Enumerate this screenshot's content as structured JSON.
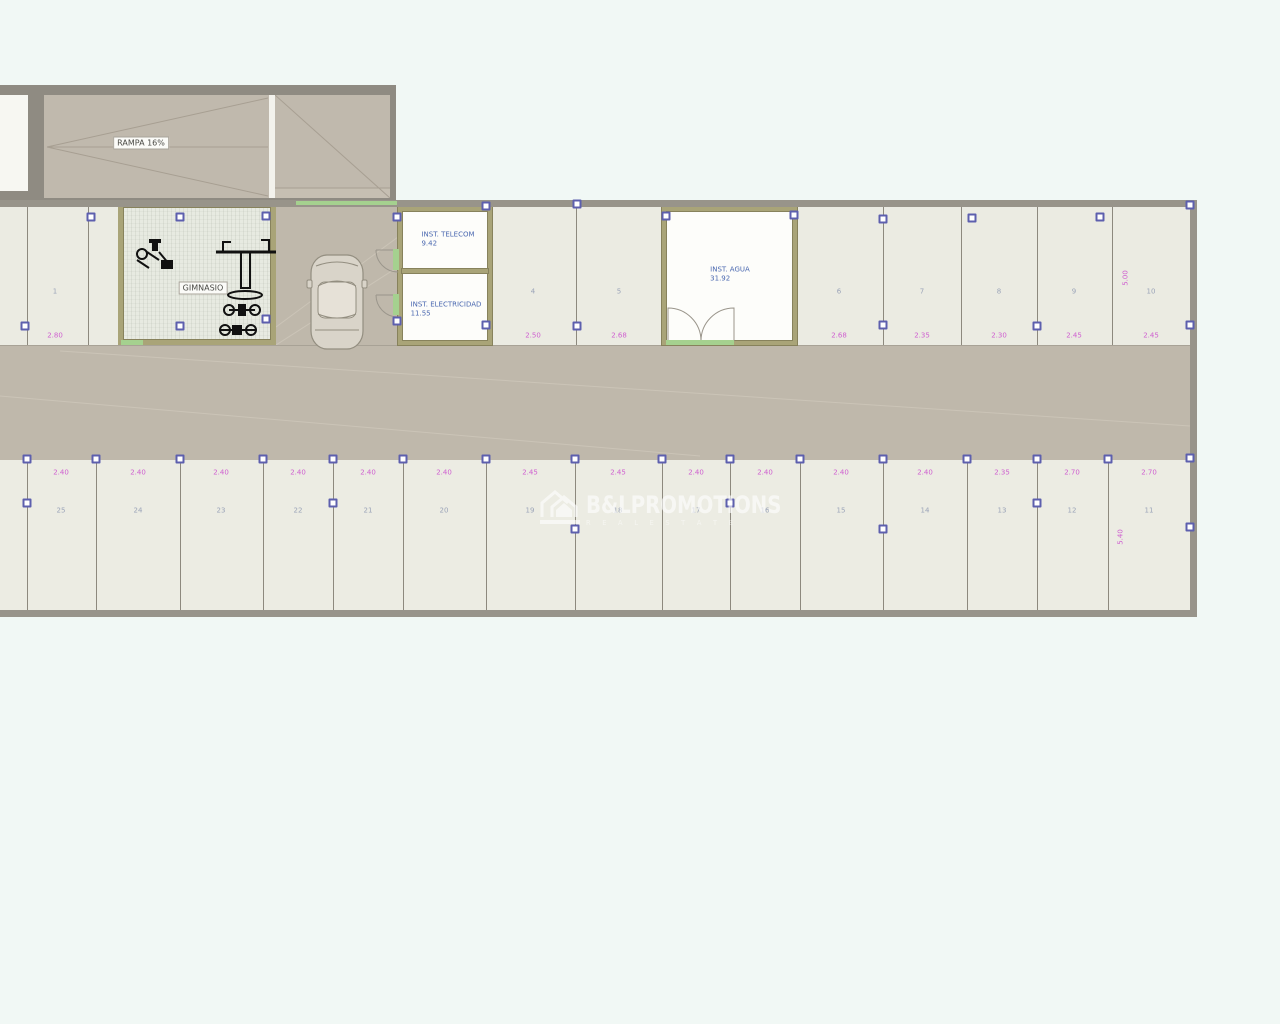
{
  "ramp": {
    "label": "RAMPA 16%"
  },
  "gym": {
    "label": "GIMNASIO"
  },
  "rooms": {
    "telecom": {
      "name": "INST. TELECOM",
      "area": "9.42"
    },
    "electricidad": {
      "name": "INST. ELECTRICIDAD",
      "area": "11.55"
    },
    "agua": {
      "name": "INST. AGUA",
      "area": "31.92"
    }
  },
  "watermark": {
    "brand": "B&LPROMOTIONS",
    "subtitle": "R E A L   E S T A T E",
    "icon": "house-icon"
  },
  "parking": {
    "top_row": {
      "zone": {
        "top": 207,
        "bottom": 345,
        "number_y": 292,
        "dim_y": 336
      },
      "dividers": [
        27,
        88,
        576,
        883,
        961,
        1037,
        1112
      ],
      "stalls": [
        {
          "cx": 55,
          "number": "1",
          "dim": "2.80"
        },
        {
          "cx": 533,
          "number": "4",
          "dim": "2.50"
        },
        {
          "cx": 619,
          "number": "5",
          "dim": "2.68"
        },
        {
          "cx": 839,
          "number": "6",
          "dim": "2.68"
        },
        {
          "cx": 922,
          "number": "7",
          "dim": "2.35"
        },
        {
          "cx": 999,
          "number": "8",
          "dim": "2.30"
        },
        {
          "cx": 1074,
          "number": "9",
          "dim": "2.45"
        },
        {
          "cx": 1151,
          "number": "10",
          "dim": "2.45"
        }
      ]
    },
    "bottom_row": {
      "zone": {
        "top": 460,
        "bottom": 610,
        "number_y": 511,
        "dim_y": 473
      },
      "dividers": [
        27,
        96,
        180,
        263,
        333,
        403,
        486,
        575,
        662,
        730,
        800,
        883,
        967,
        1037,
        1108
      ],
      "stalls": [
        {
          "cx": 61,
          "number": "25",
          "dim": "2.40"
        },
        {
          "cx": 138,
          "number": "24",
          "dim": "2.40"
        },
        {
          "cx": 221,
          "number": "23",
          "dim": "2.40"
        },
        {
          "cx": 298,
          "number": "22",
          "dim": "2.40"
        },
        {
          "cx": 368,
          "number": "21",
          "dim": "2.40"
        },
        {
          "cx": 444,
          "number": "20",
          "dim": "2.40"
        },
        {
          "cx": 530,
          "number": "19",
          "dim": "2.45"
        },
        {
          "cx": 618,
          "number": "18",
          "dim": "2.45"
        },
        {
          "cx": 696,
          "number": "17",
          "dim": "2.40"
        },
        {
          "cx": 765,
          "number": "16",
          "dim": "2.40"
        },
        {
          "cx": 841,
          "number": "15",
          "dim": "2.40"
        },
        {
          "cx": 925,
          "number": "14",
          "dim": "2.40"
        },
        {
          "cx": 1002,
          "number": "13",
          "dim": "2.35"
        },
        {
          "cx": 1072,
          "number": "12",
          "dim": "2.70"
        },
        {
          "cx": 1149,
          "number": "11",
          "dim": "2.70"
        }
      ]
    },
    "vertical_dims": [
      {
        "x": 1126,
        "y": 278,
        "text": "5.00"
      },
      {
        "x": 1121,
        "y": 537,
        "text": "5.40"
      }
    ]
  },
  "grips": [
    [
      91,
      217
    ],
    [
      180,
      217
    ],
    [
      266,
      216
    ],
    [
      25,
      326
    ],
    [
      180,
      326
    ],
    [
      266,
      319
    ],
    [
      397,
      217
    ],
    [
      397,
      321
    ],
    [
      486,
      206
    ],
    [
      577,
      204
    ],
    [
      577,
      326
    ],
    [
      486,
      325
    ],
    [
      666,
      216
    ],
    [
      794,
      215
    ],
    [
      883,
      219
    ],
    [
      972,
      218
    ],
    [
      1100,
      217
    ],
    [
      883,
      325
    ],
    [
      1037,
      326
    ],
    [
      1190,
      205
    ],
    [
      1190,
      325
    ],
    [
      27,
      459
    ],
    [
      96,
      459
    ],
    [
      180,
      459
    ],
    [
      263,
      459
    ],
    [
      333,
      459
    ],
    [
      403,
      459
    ],
    [
      486,
      459
    ],
    [
      575,
      459
    ],
    [
      662,
      459
    ],
    [
      730,
      459
    ],
    [
      800,
      459
    ],
    [
      883,
      459
    ],
    [
      967,
      459
    ],
    [
      1037,
      459
    ],
    [
      1108,
      459
    ],
    [
      1190,
      458
    ],
    [
      27,
      503
    ],
    [
      333,
      503
    ],
    [
      575,
      529
    ],
    [
      730,
      503
    ],
    [
      883,
      529
    ],
    [
      1037,
      503
    ],
    [
      1190,
      527
    ]
  ],
  "green_segments": [
    {
      "x": 296,
      "y": 201,
      "w": 101,
      "h": 4
    },
    {
      "x": 393,
      "y": 249,
      "w": 6,
      "h": 21
    },
    {
      "x": 393,
      "y": 294,
      "w": 6,
      "h": 21
    },
    {
      "x": 121,
      "y": 340,
      "w": 22,
      "h": 5
    },
    {
      "x": 666,
      "y": 340,
      "w": 68,
      "h": 5
    }
  ],
  "colors": {
    "canvas": "#f1f8f5",
    "stall_fill": "#ebebe2",
    "aisle_fill": "#bfb8ab",
    "wall_gray": "#98948a",
    "wall_olive": "#a9a478",
    "grip_border": "#5d5fae",
    "dim_text": "#cf5fd0",
    "room_text": "#4a68b0",
    "green_accent": "#a5d18f",
    "watermark": "#ffffff"
  }
}
